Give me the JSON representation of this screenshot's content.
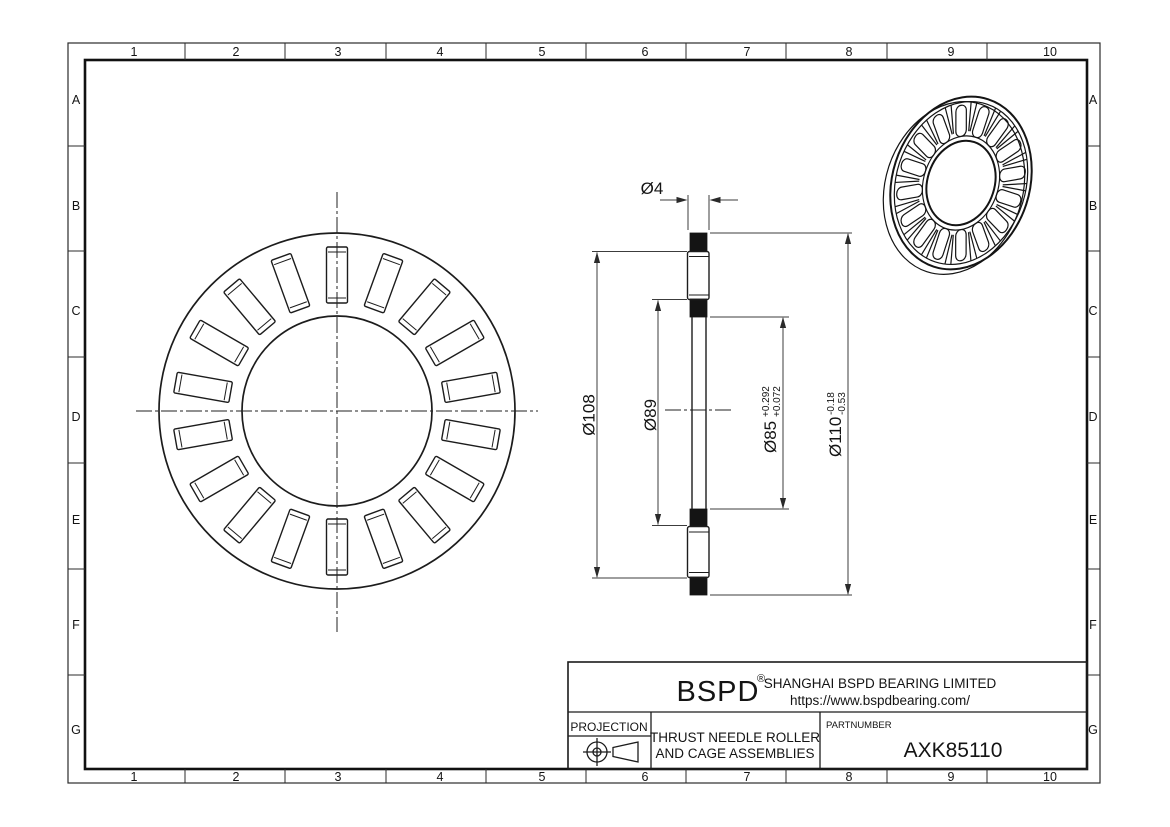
{
  "sheet": {
    "grid": {
      "columns": [
        "1",
        "2",
        "3",
        "4",
        "5",
        "6",
        "7",
        "8",
        "9",
        "10"
      ],
      "rows": [
        "A",
        "B",
        "C",
        "D",
        "E",
        "F",
        "G"
      ]
    },
    "title_block": {
      "brand": "BSPD",
      "brand_reg": "®",
      "company": "SHANGHAI BSPD BEARING LIMITED",
      "website": "https://www.bspdbearing.com/",
      "projection_label": "PROJECTION",
      "product_line1": "THRUST NEEDLE ROLLER",
      "product_line2": "AND CAGE ASSEMBLIES",
      "partnumber_label": "PARTNUMBER",
      "partnumber_value": "AXK85110"
    },
    "dimensions": {
      "roller_diameter": {
        "label": "Ø4"
      },
      "cage_outer": {
        "label": "Ø108"
      },
      "cage_inner": {
        "label": "Ø89"
      },
      "bore": {
        "nominal": "Ø85",
        "tol_upper": "+0.292",
        "tol_lower": "+0.072"
      },
      "outside": {
        "nominal": "Ø110",
        "tol_upper": "-0.18",
        "tol_lower": "-0.53"
      }
    },
    "front_view": {
      "roller_count": 18
    },
    "iso_view": {
      "roller_count": 16
    },
    "colors": {
      "line": "#1c1c1c",
      "dim_line": "#3c3c3c",
      "background": "#ffffff"
    }
  }
}
